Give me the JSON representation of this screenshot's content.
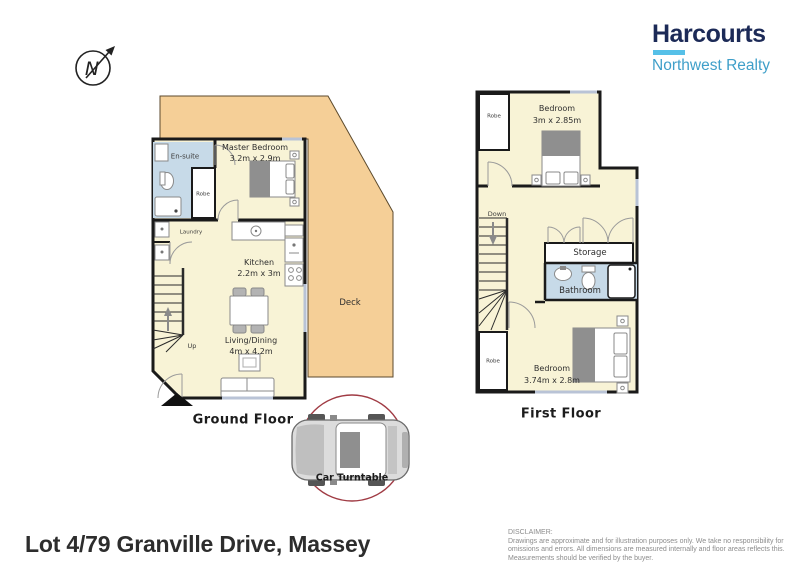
{
  "logo": {
    "brand": "Harcourts",
    "subtitle": "Northwest Realty"
  },
  "compass": {
    "letter": "N"
  },
  "ground_floor": {
    "caption": "Ground Floor",
    "ensuite": "En-suite",
    "robe": "Robe",
    "master_bedroom": "Master Bedroom",
    "master_bedroom_dims": "3.2m x 2.9m",
    "laundry": "Laundry",
    "kitchen": "Kitchen",
    "kitchen_dims": "2.2m x 3m",
    "living_dining": "Living/Dining",
    "living_dining_dims": "4m x 4.2m",
    "deck": "Deck",
    "stairs": "Up"
  },
  "first_floor": {
    "caption": "First Floor",
    "robe_top": "Robe",
    "bedroom_top": "Bedroom",
    "bedroom_top_dims": "3m x 2.85m",
    "stairs": "Down",
    "storage": "Storage",
    "bathroom": "Bathroom",
    "robe_bottom": "Robe",
    "bedroom_bottom": "Bedroom",
    "bedroom_bottom_dims": "3.74m x 2.8m"
  },
  "car_turntable": {
    "label": "Car Turntable"
  },
  "footer": {
    "address": "Lot 4/79 Granville Drive, Massey",
    "disclaimer_title": "DISCLAIMER:",
    "disclaimer_body": "Drawings are approximate and for illustration purposes only. We take no responsibility for omissions and errors. All dimensions are measured internally and floor areas reflects this. Measurements should be verified by the buyer."
  },
  "colors": {
    "deck": "#F5CF97",
    "floor": "#F8F3D6",
    "wet_area": "#C7DAE8",
    "wall": "#1A1A1A",
    "brand_navy": "#1C2A57",
    "brand_cyan": "#56C0E8",
    "brand_blue": "#3F9FC9",
    "turntable_ring": "#A03B44"
  }
}
